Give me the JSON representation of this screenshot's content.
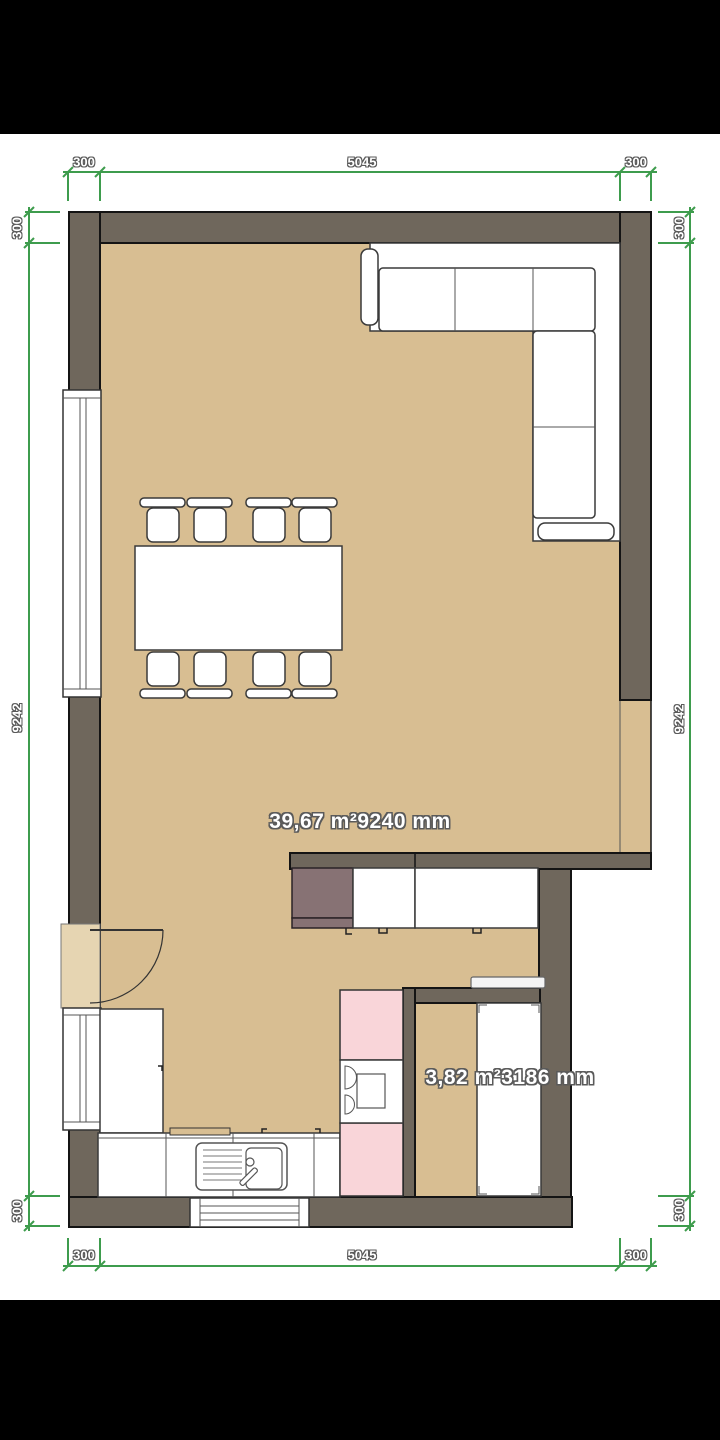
{
  "colors": {
    "letterbox": "#000000",
    "floor": "#D8BE92",
    "floor_light": "#E6D5B2",
    "wall": "#6F675C",
    "outline": "#141414",
    "pink": "#F9D5D9",
    "appliance_mauve": "#877274",
    "dimension_green": "#3E9C4D",
    "label_text": "#FFFFFF",
    "label_outline": "#5A5A5A"
  },
  "dims": {
    "top": {
      "left": "300",
      "center": "5045",
      "right": "300"
    },
    "bottom": {
      "left": "300",
      "center": "5045",
      "right": "300"
    },
    "left": {
      "top": "300",
      "center": "9242",
      "bottom": "300"
    },
    "right": {
      "top": "300",
      "center": "9242",
      "bottom": "300"
    }
  },
  "rooms": {
    "living_dining": {
      "area": "39,67 m²",
      "length": "9240 mm",
      "label": "39,67 m²9240 mm"
    },
    "bathroom": {
      "area": "3,82 m²",
      "length": "3186 mm",
      "label": "3,82 m²3186 mm"
    }
  },
  "furniture": {
    "sofa": "corner-sofa",
    "table": "dining-table",
    "chairs": "dining-chairs-x8",
    "fridge": "refrigerator",
    "wall_cabinets": "kitchen-wall-cabinets",
    "tall_cabinet": "tall-cabinet",
    "counter": "kitchen-counter-with-sink",
    "cooktop": "cooktop-unit",
    "bathtub": "bathtub",
    "shelf": "wall-shelf",
    "door": "entry-door",
    "windows": "windows-x3"
  }
}
